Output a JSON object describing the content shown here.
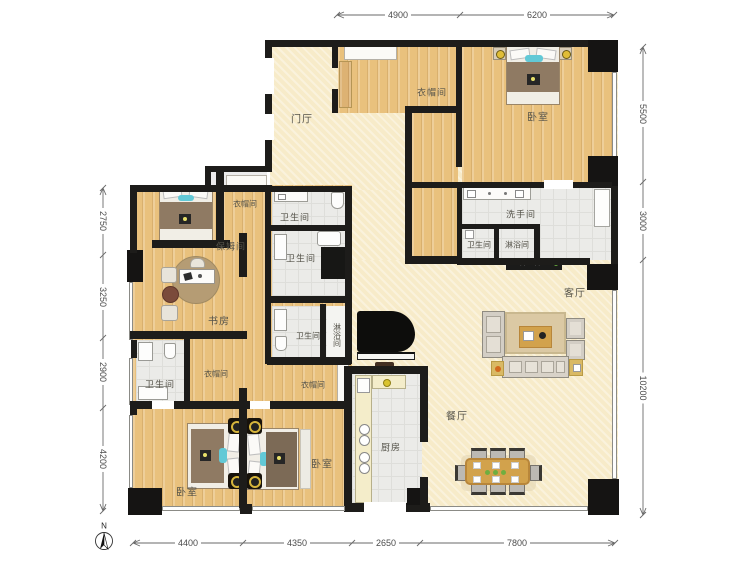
{
  "floor_plan": {
    "compass_label": "N",
    "rooms": {
      "entry": "门厅",
      "cloak_top": "衣帽间",
      "bedroom_master": "卧室",
      "washroom": "洗手间",
      "wc_wash": "卫生间",
      "shower_wash": "淋浴间",
      "living": "客厅",
      "bath1": "卫生间",
      "cloak_small": "衣帽间",
      "nanny": "保姆间",
      "bath2": "卫生间",
      "study": "书房",
      "bath3": "卫生间",
      "shower_mid": "淋浴间",
      "wc4": "卫生间",
      "cloak_left": "衣帽间",
      "cloak_mid": "衣帽间",
      "dining": "餐厅",
      "kitchen": "厨房",
      "bedroom_sw": "卧室",
      "bedroom_s": "卧室"
    },
    "dimensions": {
      "top": [
        "4900",
        "6200"
      ],
      "right": [
        "5500",
        "3000",
        "10200"
      ],
      "left": [
        "2750",
        "3250",
        "2900",
        "4200"
      ],
      "bottom": [
        "4400",
        "4350",
        "2650",
        "7800"
      ]
    },
    "colors": {
      "wall": "#1d1c1a",
      "wood_floor": "#e9c17d",
      "hall_floor": "#f7ebc9",
      "tile_floor": "#ebebe8",
      "accent_teal": "#62c9d6",
      "table_wood": "#d2a24c"
    }
  }
}
